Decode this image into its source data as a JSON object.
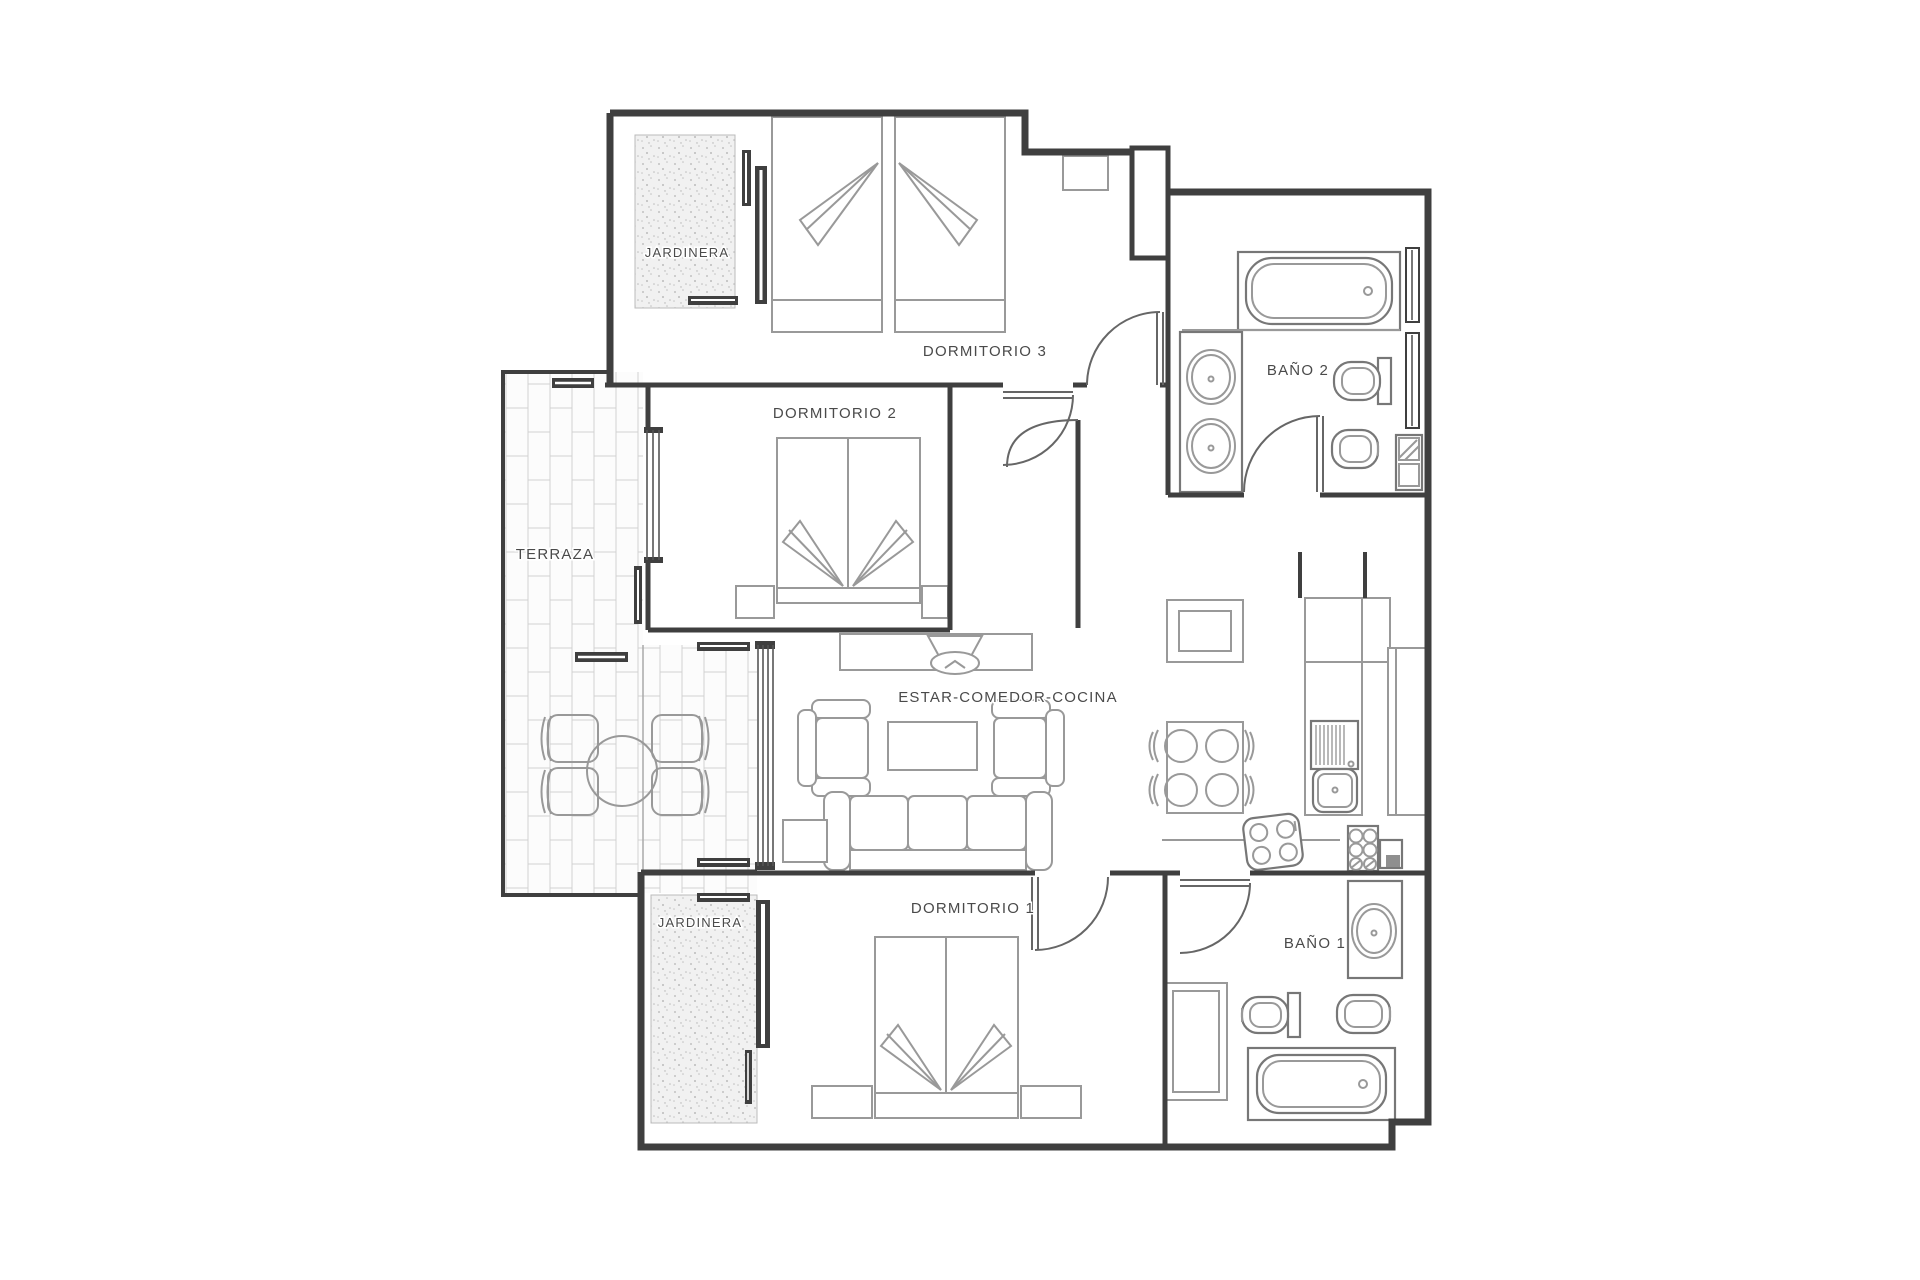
{
  "plan": {
    "type": "apartment-floor-plan",
    "language": "es",
    "description": "2nd-floor flat with three bedrooms, two bathrooms, living-dining-kitchen, terrace and two planters"
  },
  "rooms": {
    "jardinera_top": {
      "label": "JARDINERA"
    },
    "dormitorio_3": {
      "label": "DORMITORIO 3"
    },
    "bano_2": {
      "label": "BAÑO 2"
    },
    "dormitorio_2": {
      "label": "DORMITORIO 2"
    },
    "terraza": {
      "label": "TERRAZA"
    },
    "estar_comedor_cocina": {
      "label": "ESTAR-COMEDOR-COCINA"
    },
    "dormitorio_1": {
      "label": "DORMITORIO 1"
    },
    "bano_1": {
      "label": "BAÑO 1"
    },
    "jardinera_bottom": {
      "label": "JARDINERA"
    }
  },
  "furniture": {
    "dormitorio_3": [
      "twin-bed",
      "twin-bed",
      "nightstand"
    ],
    "dormitorio_2": [
      "double-bed",
      "nightstand",
      "nightstand"
    ],
    "dormitorio_1": [
      "double-bed",
      "nightstand",
      "nightstand",
      "closet"
    ],
    "bano_2": [
      "bathtub",
      "basin",
      "basin",
      "toilet",
      "bidet",
      "washer"
    ],
    "bano_1": [
      "bathtub",
      "basin",
      "toilet",
      "bidet"
    ],
    "estar_comedor_cocina": [
      "tv-unit",
      "tv",
      "armchair",
      "armchair",
      "coffee-table",
      "sofa",
      "side-table",
      "dining-table",
      "chair",
      "chair",
      "chair",
      "chair",
      "hall-cabinet",
      "kitchen-sink",
      "tall-units",
      "hob",
      "oven-symbol"
    ],
    "terraza": [
      "round-table",
      "chair",
      "chair",
      "chair",
      "chair"
    ]
  },
  "colors": {
    "wall": "#3f3f3f",
    "furniture": "#999999",
    "fixture": "#777777",
    "tile_line": "#d2d2d2",
    "label": "#4a4a4a",
    "background": "#ffffff"
  }
}
